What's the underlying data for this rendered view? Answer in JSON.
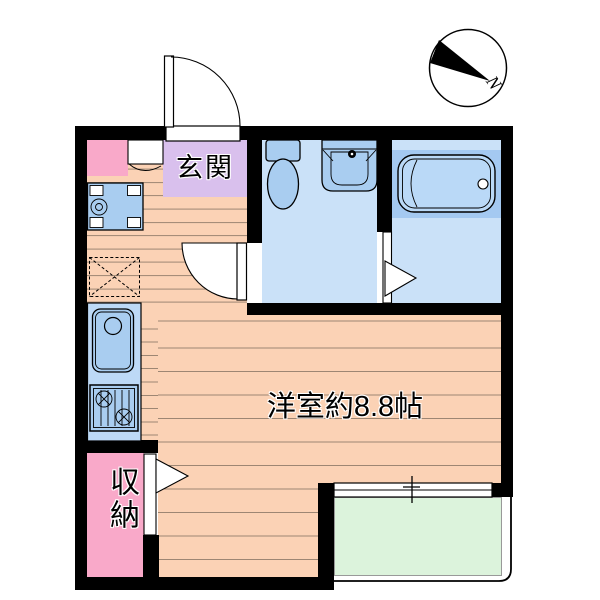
{
  "labels": {
    "entrance": "玄関",
    "main_room": "洋室約8.8帖",
    "storage": "収納",
    "north": "N"
  },
  "colors": {
    "bg": "#ffffff",
    "wall": "#000000",
    "floor": "#fbd2b5",
    "floor_line": "#9d8673",
    "pink": "#f9a9c9",
    "lavender": "#d9c0ed",
    "wet_floor": "#cae1f8",
    "fixture_blue": "#a9cdf0",
    "counter_blue": "#bdd9f6",
    "bath_platform": "#a4c9f1",
    "bathtub": "#bad9f7",
    "balcony_green": "#dcf3dc",
    "balcony_edge": "#999999"
  }
}
